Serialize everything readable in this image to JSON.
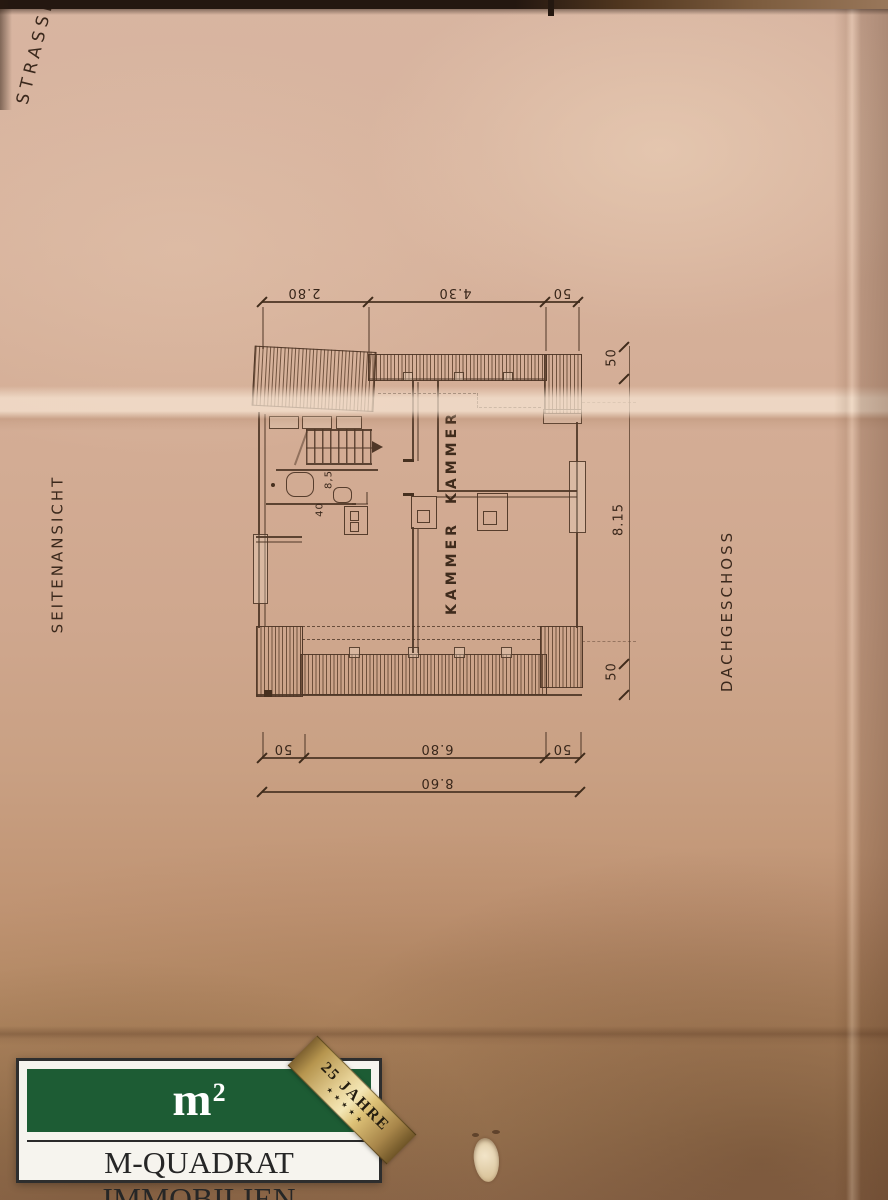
{
  "document": {
    "annotations": {
      "strasse": "STRASSE",
      "seitenansicht": "SEITENANSICHT",
      "dachgeschoss": "DACHGESCHOSS"
    },
    "rooms": {
      "kammer_top": "KAMMER",
      "kammer_bottom": "KAMMER"
    },
    "dimensions": {
      "top_left_width": "2.80",
      "top_mid_width": "4.30",
      "top_right_wall": "50",
      "right_top_wall": "50",
      "right_height": "8.15",
      "right_bottom_wall": "50",
      "bottom_left_wall": "50",
      "bottom_inner_width": "6.80",
      "bottom_right_wall": "50",
      "bottom_total_width": "8.60",
      "bath_width": "40",
      "bath_depth": "8,5"
    }
  },
  "logo": {
    "symbol_base": "m",
    "symbol_exp": "2",
    "company": "M-QUADRAT IMMOBILIEN",
    "ribbon_text": "25 JAHRE",
    "ribbon_stars": "★★★★★",
    "colors": {
      "brand_green": "#1d5c34",
      "ribbon_gold": "#c9a85f"
    }
  }
}
